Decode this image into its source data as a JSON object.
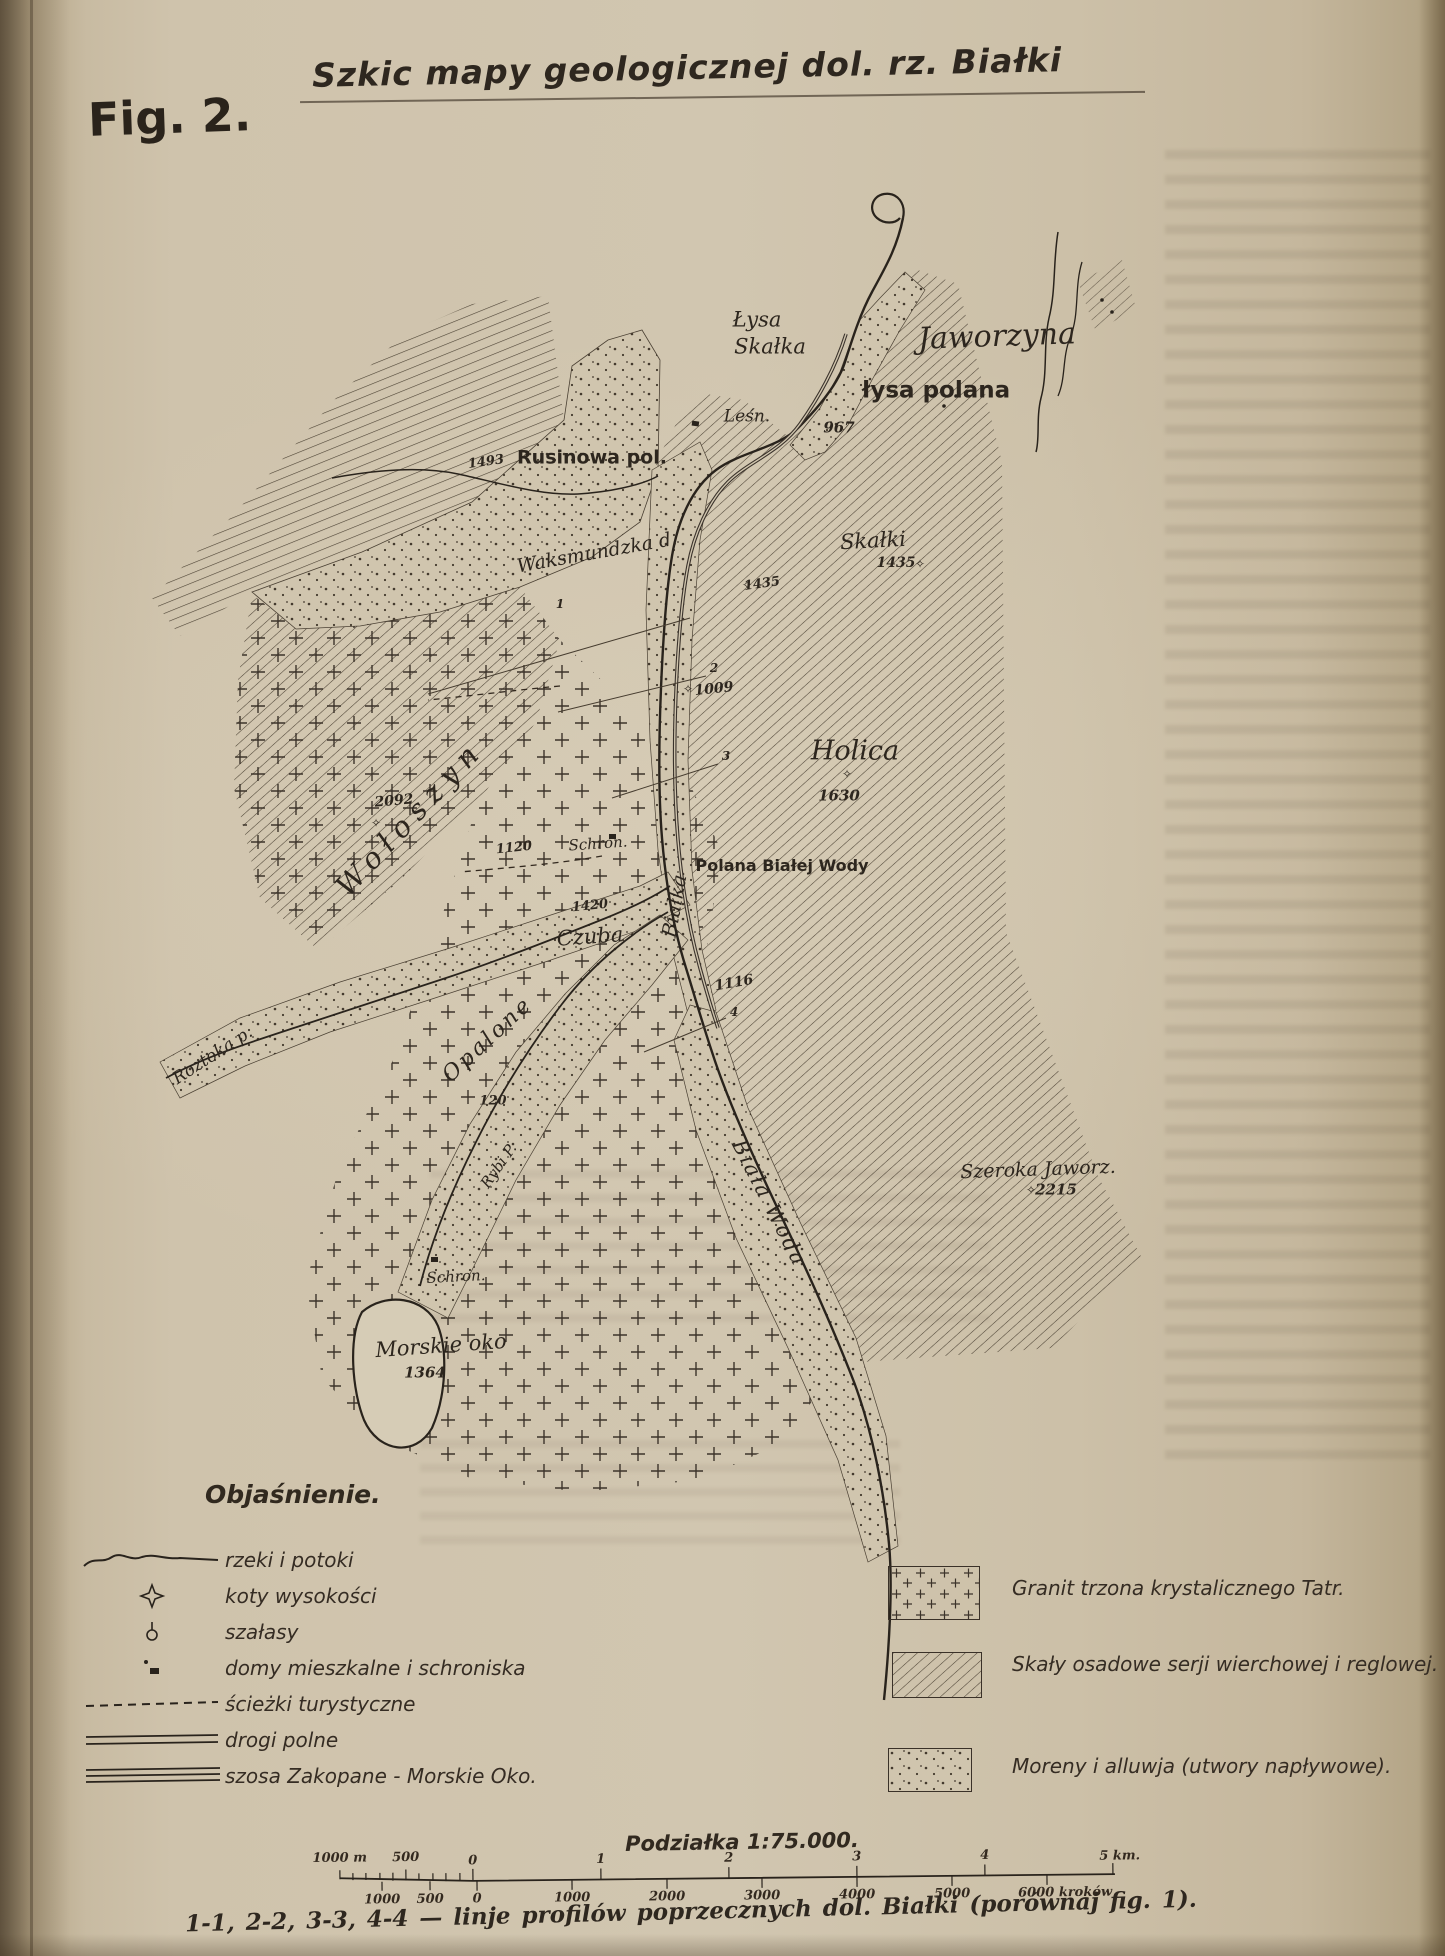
{
  "page": {
    "figure_label": "Fig. 2.",
    "title": "Szkic mapy geologicznej dol. rz. Białki"
  },
  "map": {
    "labels": [
      {
        "id": "lysa",
        "text": "Łysa"
      },
      {
        "id": "skalka",
        "text": "Skałka"
      },
      {
        "id": "jaworzyna",
        "text": "Jaworzyna"
      },
      {
        "id": "lysa-polana",
        "text": "łysa polana"
      },
      {
        "id": "lesn",
        "text": "Leśn."
      },
      {
        "id": "elev-967",
        "text": "967"
      },
      {
        "id": "elev-1493",
        "text": "1493"
      },
      {
        "id": "rusinowa-pol",
        "text": "Rusinowa pol."
      },
      {
        "id": "waksmundzka",
        "text": "Waksmundzka d."
      },
      {
        "id": "skalki",
        "text": "Skałki"
      },
      {
        "id": "elev-1435-a",
        "text": "1435"
      },
      {
        "id": "elev-1435-b",
        "text": "1435"
      },
      {
        "id": "elev-1009",
        "text": "1009"
      },
      {
        "id": "holica",
        "text": "Holica"
      },
      {
        "id": "elev-1630",
        "text": "1630"
      },
      {
        "id": "woloszyn",
        "text": "Wołoszyn"
      },
      {
        "id": "elev-2092",
        "text": "2092"
      },
      {
        "id": "elev-1120",
        "text": "1120"
      },
      {
        "id": "schron-1",
        "text": "Schron."
      },
      {
        "id": "polana-bialej-wody",
        "text": "Polana Białej Wody"
      },
      {
        "id": "bialka",
        "text": "Białka"
      },
      {
        "id": "elev-1420",
        "text": "1420"
      },
      {
        "id": "czuba",
        "text": "Czuba"
      },
      {
        "id": "opalone",
        "text": "Opalone"
      },
      {
        "id": "elev-1116",
        "text": "1116"
      },
      {
        "id": "roztoka-p",
        "text": "Roztoka p."
      },
      {
        "id": "elev-120",
        "text": "120"
      },
      {
        "id": "rybi-p",
        "text": "Rybi P."
      },
      {
        "id": "biala-woda",
        "text": "Biała Woda"
      },
      {
        "id": "szeroka-jaworz",
        "text": "Szeroka Jaworz."
      },
      {
        "id": "elev-2215",
        "text": "2215"
      },
      {
        "id": "schron-2",
        "text": "Schron."
      },
      {
        "id": "morskie-oko",
        "text": "Morskie oko"
      },
      {
        "id": "elev-1364",
        "text": "1364"
      },
      {
        "id": "profile-1",
        "text": "1"
      },
      {
        "id": "profile-2",
        "text": "2"
      },
      {
        "id": "profile-3",
        "text": "3"
      },
      {
        "id": "profile-4",
        "text": "4"
      }
    ]
  },
  "icons": {
    "elevation_marker": "✧"
  },
  "legend": {
    "heading": "Objaśnienie.",
    "items": [
      {
        "symbol": "river-squiggle",
        "label": "rzeki i potoki"
      },
      {
        "symbol": "elevation-diamond",
        "label": "koty wysokości"
      },
      {
        "symbol": "shelter-circle",
        "label": "szałasy"
      },
      {
        "symbol": "house-square",
        "label": "domy mieszkalne i schroniska"
      },
      {
        "symbol": "dashed-line",
        "label": "ścieżki turystyczne"
      },
      {
        "symbol": "double-line",
        "label": "drogi polne"
      },
      {
        "symbol": "triple-line",
        "label": "szosa Zakopane - Morskie Oko."
      }
    ],
    "geology": [
      {
        "pattern": "granite-crosses",
        "label": "Granit trzona krystalicznego Tatr."
      },
      {
        "pattern": "diagonal-hatching",
        "label": "Skały osadowe serji wierchowej i reglowej."
      },
      {
        "pattern": "dotted",
        "label": "Moreny i alluwja (utwory napływowe)."
      }
    ]
  },
  "scale": {
    "title": "Podziałka 1:75.000.",
    "upper_ticks": [
      "1000 m",
      "500",
      "0",
      "1",
      "2",
      "3",
      "4",
      "5 km."
    ],
    "lower_ticks": [
      "1000",
      "500",
      "0",
      "1000",
      "2000",
      "3000",
      "4000",
      "5000",
      "6000 kroków"
    ]
  },
  "caption": "1-1, 2-2, 3-3, 4-4 — linje profilów poprzecznych dol. Białki (porównaj fig. 1)."
}
